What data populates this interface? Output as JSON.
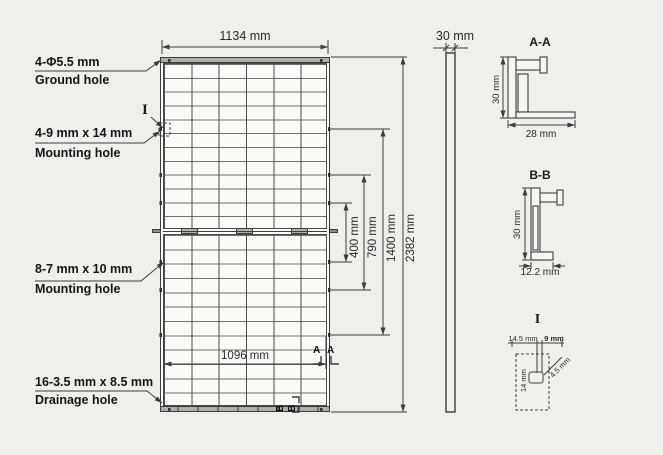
{
  "drawing": {
    "front": {
      "top_width": "1134 mm",
      "bottom_width": "1096 mm",
      "callouts": [
        {
          "dim": "4-Φ5.5 mm",
          "name": "Ground hole"
        },
        {
          "dim": "4-9 mm x 14 mm",
          "name": "Mounting hole"
        },
        {
          "dim": "8-7 mm x 10 mm",
          "name": "Mounting hole"
        },
        {
          "dim": "16-3.5 mm x 8.5 mm",
          "name": "Drainage hole"
        }
      ],
      "detail_ref": "I",
      "section_a_mark": "A",
      "section_b_mark": "B"
    },
    "side": {
      "thickness": "30 mm",
      "heights": [
        "400 mm",
        "790 mm",
        "1400 mm",
        "2382 mm"
      ]
    },
    "section_aa": {
      "title": "A-A",
      "height": "30 mm",
      "width": "28 mm"
    },
    "section_bb": {
      "title": "B-B",
      "height": "30 mm",
      "width": "12.2 mm"
    },
    "detail_i": {
      "title": "I",
      "offset": "14.5 mm",
      "slot_width": "9 mm",
      "slot_length": "14 mm",
      "radius": "4.5 mm"
    }
  }
}
